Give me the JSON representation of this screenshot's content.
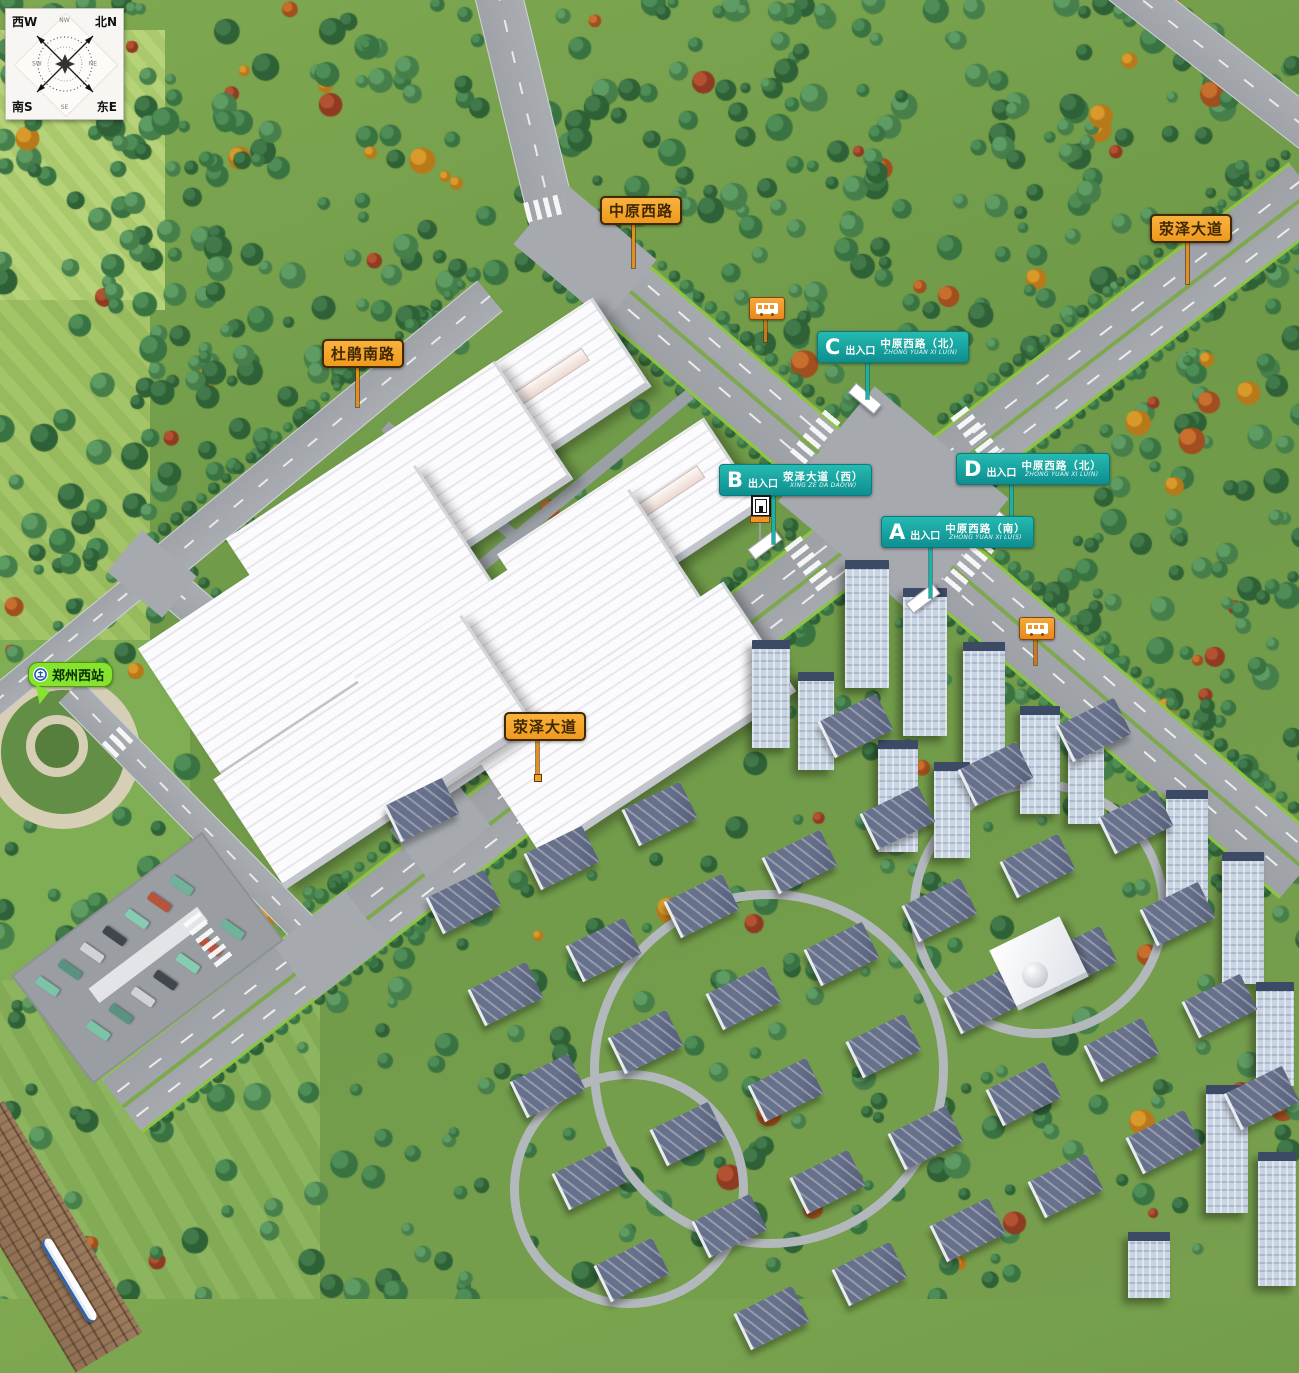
{
  "compass": {
    "corner_nw": "西W",
    "corner_ne": "北N",
    "corner_sw": "南S",
    "corner_se": "东E",
    "ordinal_top": "NW",
    "ordinal_right": "NE",
    "ordinal_bottom": "SE",
    "ordinal_left": "SW"
  },
  "road_labels": {
    "zhongyuan_xilu": "中原西路",
    "xingze_dadao_north": "荥泽大道",
    "dujuan_nanlu": "杜鹃南路",
    "xingze_dadao_south": "荥泽大道"
  },
  "entrances": [
    {
      "letter": "A",
      "gate_word": "出入口",
      "road": "中原西路（南）",
      "pinyin": "ZHONG YUAN XI LU(S)"
    },
    {
      "letter": "B",
      "gate_word": "出入口",
      "road": "荥泽大道（西）",
      "pinyin": "XING ZE DA DAO(W)"
    },
    {
      "letter": "C",
      "gate_word": "出入口",
      "road": "中原西路（北）",
      "pinyin": "ZHONG YUAN XI LU(N)"
    },
    {
      "letter": "D",
      "gate_word": "出入口",
      "road": "中原西路（北）",
      "pinyin": "ZHONG YUAN XI LU(N)"
    }
  ],
  "station": {
    "name": "郑州西站"
  },
  "icons": {
    "station_icon": "railway-logo",
    "bus_stop_icon": "bus",
    "entrance_gate": "gate"
  },
  "colors": {
    "label_orange": "#F6A22C",
    "marker_teal": "#12A3A3",
    "station_green": "#86E431",
    "road_gray": "#A6AAAF",
    "edge_green": "#8CC63F"
  }
}
